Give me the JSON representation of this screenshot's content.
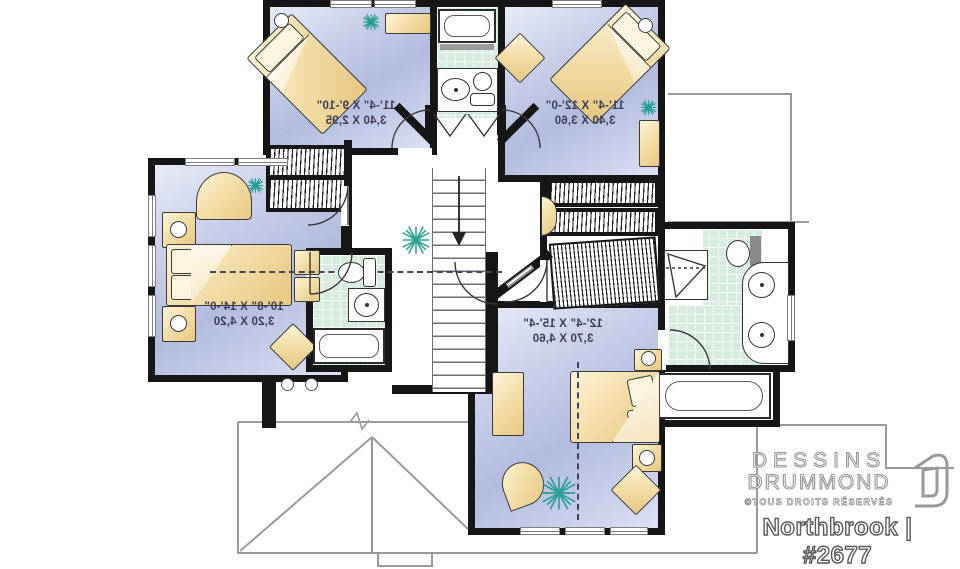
{
  "plan": {
    "text_mirrored": true,
    "rooms": [
      {
        "name": "bedroom-top-left",
        "dimensions_imperial": "11'-4\" X 9'-10\"",
        "dimensions_metric": "3,40 X 2,95"
      },
      {
        "name": "bedroom-top-right",
        "dimensions_imperial": "11'-4\" X 12'-0\"",
        "dimensions_metric": "3,40 X 3,60"
      },
      {
        "name": "bedroom-left",
        "dimensions_imperial": "10'-8\" X 14'-0\"",
        "dimensions_metric": "3,20 X 4,20"
      },
      {
        "name": "bedroom-bottom",
        "dimensions_imperial": "12'-4\" X 15'-4\"",
        "dimensions_metric": "3,70 X 4,60"
      }
    ]
  },
  "branding": {
    "company_line1": "DESSINS",
    "company_line2": "DRUMMOND",
    "rights_notice": "©TOUS DROITS RÉSERVÉS",
    "plan_title": "Northbrook | #2677"
  },
  "colors": {
    "wall": "#161616",
    "bedroom_floor": "#c3cae6",
    "bathroom_tile": "#d7ebdf",
    "furniture_wood": "#f0d9a2",
    "plant_green": "#1f9e8e",
    "roof_outline": "#9a9a9a",
    "logo_outline": "#9a9a9a",
    "title_outline": "#5c5c5c",
    "dimension_text": "#3d3d55"
  }
}
